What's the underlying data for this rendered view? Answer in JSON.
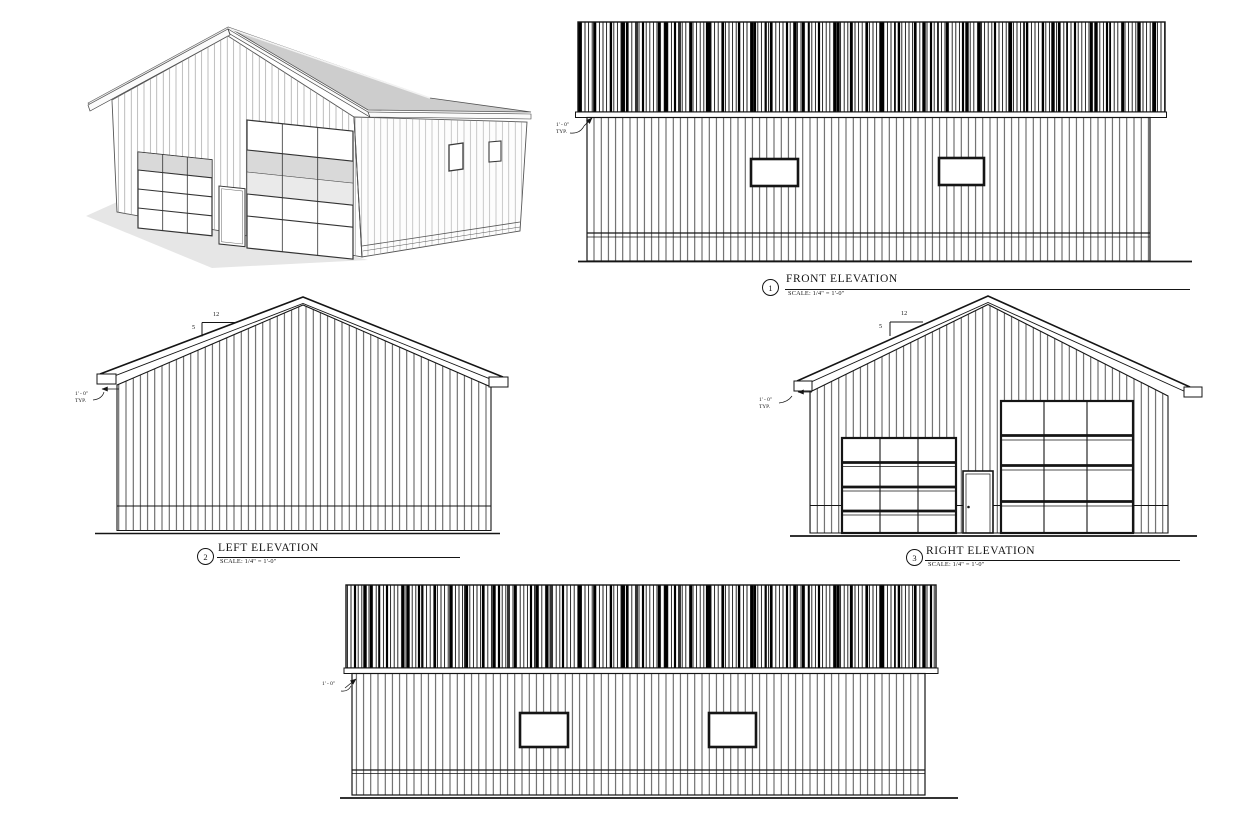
{
  "sheet": {
    "background": "#ffffff",
    "line_color": "#151515",
    "roof_gray": "#cdcdcd",
    "panel_gray": "#d9d9d9",
    "shadow_gray": "#e6e6e6"
  },
  "views": {
    "perspective": {
      "name": "3d-perspective-rendering"
    },
    "front": {
      "number": "1",
      "title": "FRONT ELEVATION",
      "scale": "SCALE:  1/4\" = 1'-0\"",
      "overhang": "1' - 0\"",
      "overhang_typ": "TYP."
    },
    "left": {
      "number": "2",
      "title": "LEFT ELEVATION",
      "scale": "SCALE:  1/4\" = 1'-0\"",
      "overhang": "1' - 0\"",
      "overhang_typ": "TYP.",
      "pitch_run": "12",
      "pitch_rise": "5"
    },
    "right": {
      "number": "3",
      "title": "RIGHT ELEVATION",
      "scale": "SCALE:  1/4\" = 1'-0\"",
      "overhang": "1' - 0\"",
      "overhang_typ": "TYP.",
      "pitch_run": "12",
      "pitch_rise": "5"
    },
    "rear": {
      "overhang": "1' - 0\""
    }
  }
}
